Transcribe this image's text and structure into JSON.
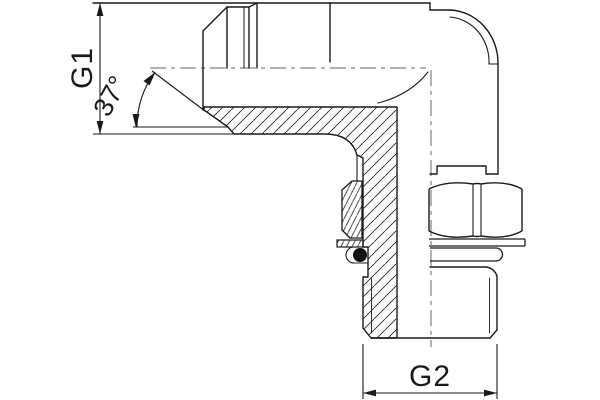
{
  "drawing": {
    "title": "90-degree elbow fitting cross-section drawing",
    "labels": {
      "g1": "G1",
      "angle": "37°",
      "g2": "G2"
    },
    "colors": {
      "line": "#1a1a1a",
      "centerline": "#666666",
      "background": "#ffffff"
    }
  }
}
